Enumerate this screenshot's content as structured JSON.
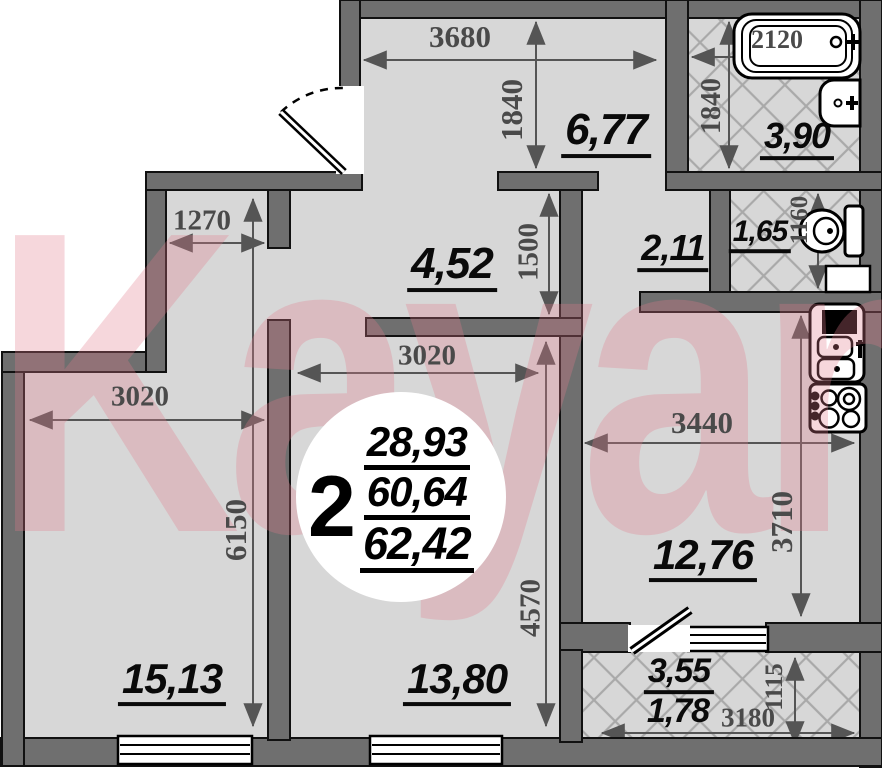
{
  "watermark": "Kayan",
  "badge": {
    "rooms": "2",
    "values": [
      "28,93",
      "60,64",
      "62,42"
    ]
  },
  "areas": {
    "hallway": "6,77",
    "bathroom": "3,90",
    "lobby": "2,11",
    "wc": "1,65",
    "inner_hall": "4,52",
    "kitchen": "12,76",
    "bedroom": "15,13",
    "living_room": "13,80",
    "balcony": "3,55",
    "balcony_reduced": "1,78"
  },
  "dimensions": {
    "hall_width": "3680",
    "hall_depth": "1840",
    "bath_length": "2120",
    "bath_depth": "1840",
    "closet_width": "1270",
    "inner_hall_depth": "1500",
    "wc_depth": "1160",
    "living_width": "3020",
    "bedroom_width": "3020",
    "kitchen_width": "3440",
    "left_side_depth": "6150",
    "kitchen_depth": "3710",
    "living_depth": "4570",
    "balcony_depth": "1115",
    "balcony_width": "3180"
  }
}
